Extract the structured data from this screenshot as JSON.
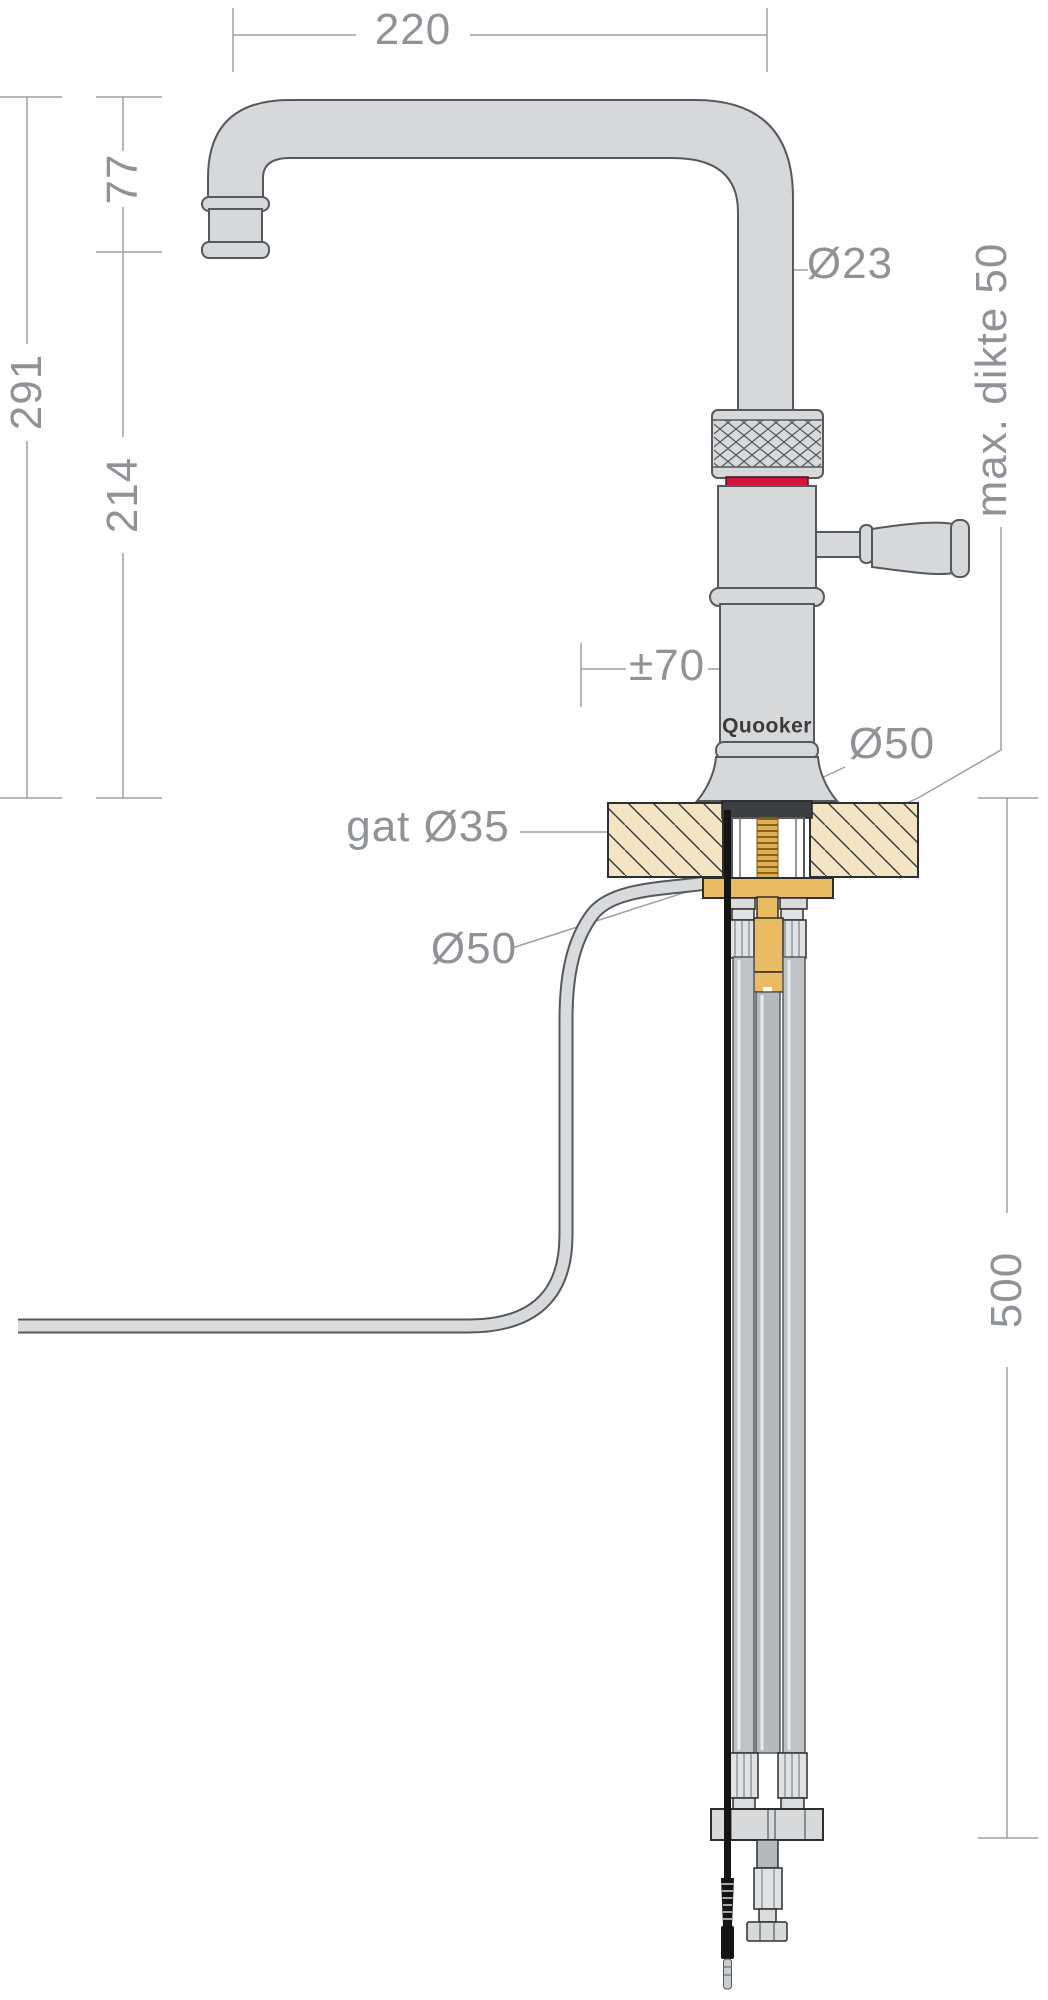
{
  "drawing": {
    "title": "Quooker tap installation dimension drawing",
    "brand_logo": "Quooker",
    "labels": {
      "spout_reach": "220",
      "spout_drop": "77",
      "total_height": "291",
      "body_height": "214",
      "spout_diameter": "Ø23",
      "max_counter_thickness": "max. dikte 50",
      "swivel_offset": "±70",
      "base_diameter": "Ø50",
      "hole_diameter": "gat Ø35",
      "washer_diameter": "Ø50",
      "under_counter_depth": "500"
    },
    "colors": {
      "metal_fill": "#d6d8da",
      "outline": "#55595e",
      "dimension_grey": "#8f9397",
      "red_ring": "#d6123e",
      "countertop_tan": "#f3e5c3",
      "brass": "#e9bb63",
      "thread_gold": "#dcae55",
      "seal_dark": "#3b3f42",
      "hose_grey": "#c0c3c5",
      "cable_black": "#141414"
    }
  }
}
